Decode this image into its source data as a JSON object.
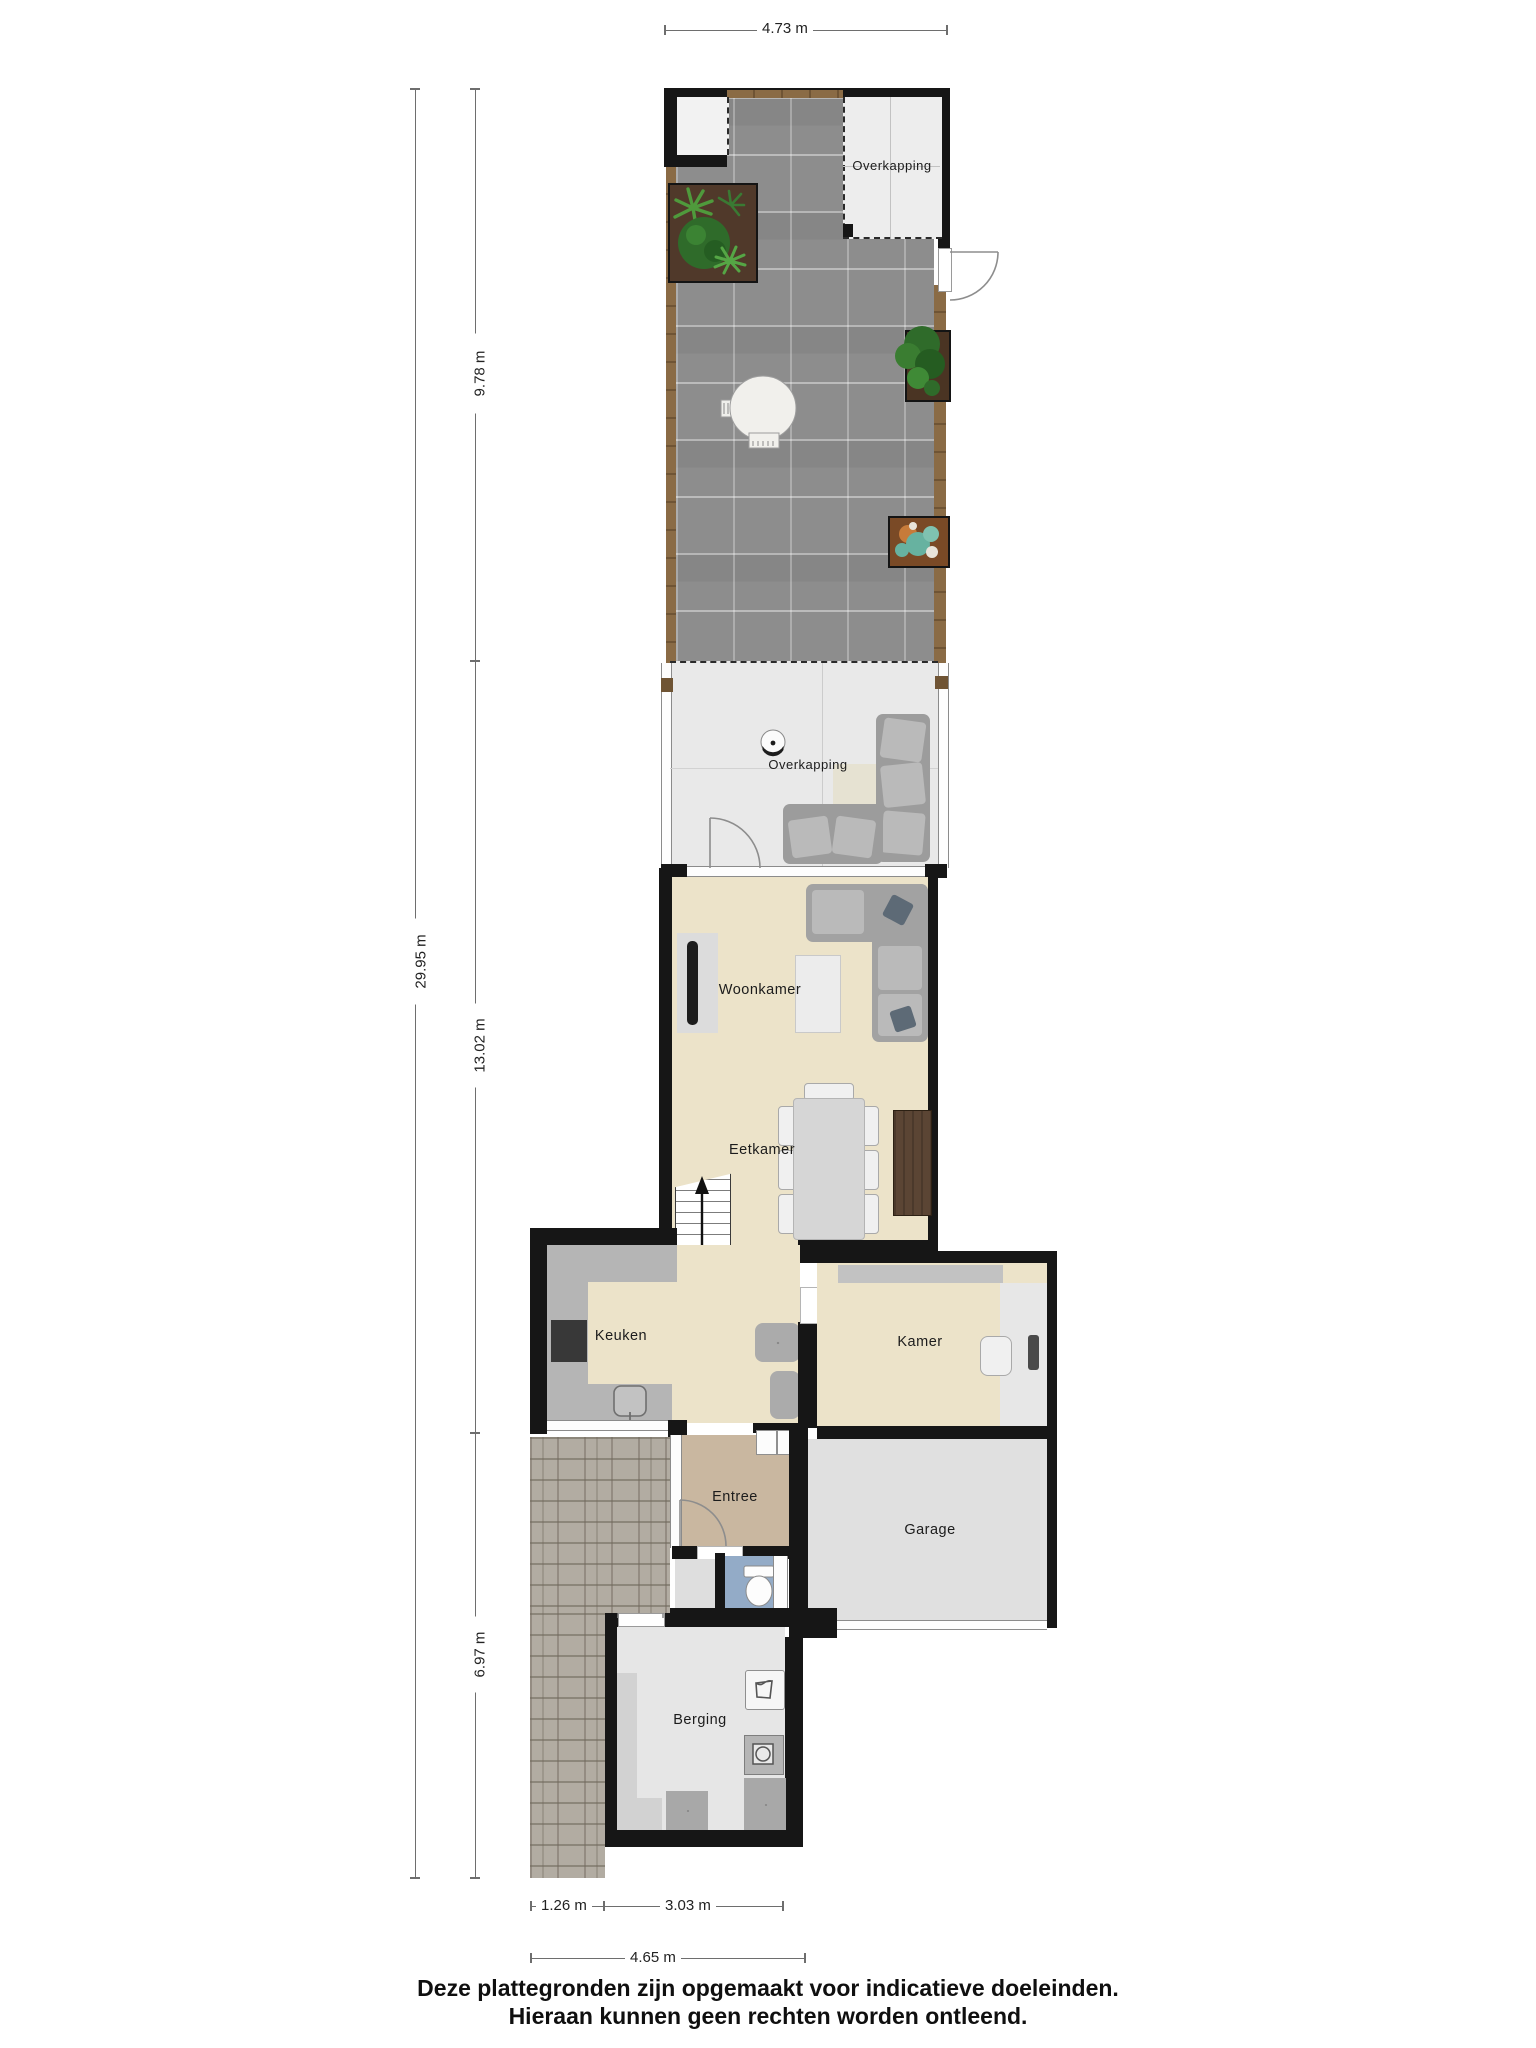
{
  "plan_title": "Begane grond met tuin plattegrond",
  "rooms": {
    "overkapping_top": {
      "label": "Overkapping"
    },
    "overkapping_terras": {
      "label": "Overkapping"
    },
    "woonkamer": {
      "label": "Woonkamer"
    },
    "eetkamer": {
      "label": "Eetkamer"
    },
    "keuken": {
      "label": "Keuken"
    },
    "kamer": {
      "label": "Kamer"
    },
    "entree": {
      "label": "Entree"
    },
    "garage": {
      "label": "Garage"
    },
    "berging": {
      "label": "Berging"
    }
  },
  "dimensions": {
    "top_width": "4.73 m",
    "total_depth": "29.95 m",
    "garden_depth": "9.78 m",
    "house_depth": "13.02 m",
    "rear_depth": "6.97 m",
    "path_width": "1.26 m",
    "berging_width": "3.03 m",
    "total_width": "4.65 m"
  },
  "footer": {
    "line1": "Deze plattegronden zijn opgemaakt voor indicatieve doeleinden.",
    "line2": "Hieraan kunnen geen rechten worden ontleend."
  },
  "icons": {
    "entrance-arrow": "black triangle pointing right at front door",
    "stairs-up-arrow": "arrow up staircase",
    "ventilation-fan": "six-spoke asterisk symbol",
    "toilet": "toilet bowl with cistern",
    "sink": "rounded square sink with tap",
    "washing-machine": "square with circle drum",
    "laundry-basket": "basket outline in white box",
    "fire-bowl": "round bowl with dot",
    "statue": "white garden vase ornament",
    "door-swing": "quarter circle door arc"
  },
  "colors": {
    "wall": "#161616",
    "garden_tiles": "#8d8d8d",
    "wood_deck": "#8a6b45",
    "floor_living": "#ece3c9",
    "floor_terrace": "#e9e9e9",
    "floor_entree": "#c9b7a0",
    "floor_toilet": "#93abc7",
    "floor_garage": "#e0e0e0",
    "floor_berging": "#e6e6e6",
    "paving": "#b2aca2",
    "counter": "#b5b5b5",
    "sofa": "#a2a2a2",
    "soil": "#50392a",
    "foliage": "#3f7d3a"
  }
}
